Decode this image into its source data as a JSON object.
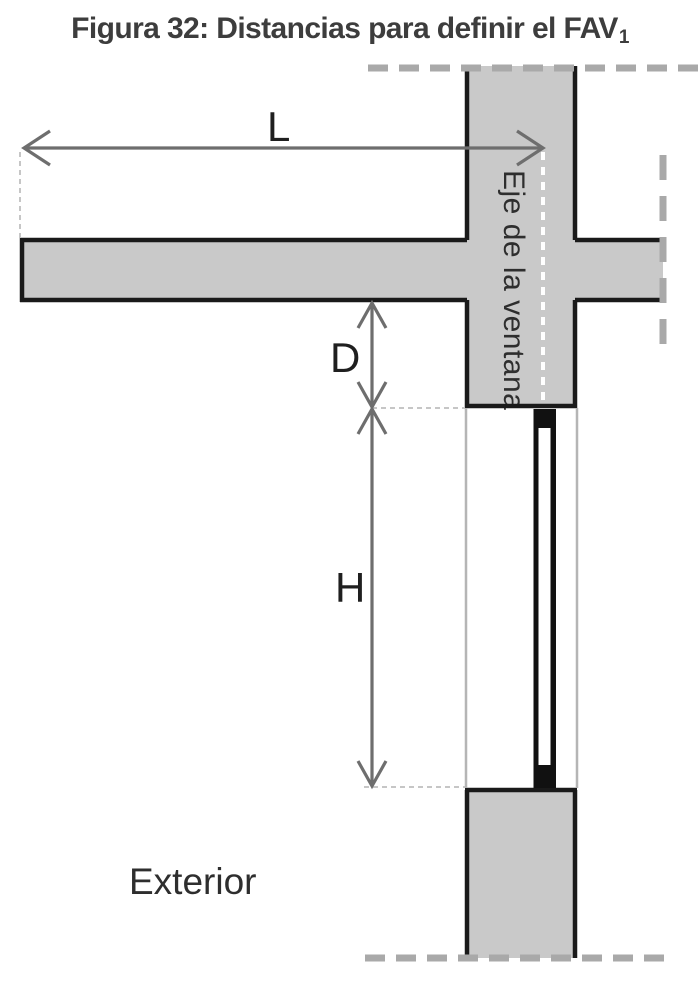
{
  "figure": {
    "title": {
      "main": "Figura 32: Distancias para definir el FAV",
      "subscript": "1"
    },
    "labels": {
      "horizontal_distance": "L",
      "vertical_offset": "D",
      "window_height": "H",
      "window_axis": "Eje de la ventana",
      "exterior": "Exterior"
    },
    "colors": {
      "background": "#ffffff",
      "wall_fill": "#c9c9c9",
      "wall_outline": "#1a1a1a",
      "boundary_dash": "#a9a9a9",
      "arrow": "#6e6e6e",
      "guide_dash": "#c6c6c6",
      "jamb_guide": "#b5b5b5",
      "window_axis_dots": "#ffffff",
      "window_frame": "#111111",
      "window_glass": "#ffffff",
      "title_text": "#3d3d3d",
      "label_text": "#1f1f1f",
      "axis_text": "#2e2e2e"
    }
  }
}
